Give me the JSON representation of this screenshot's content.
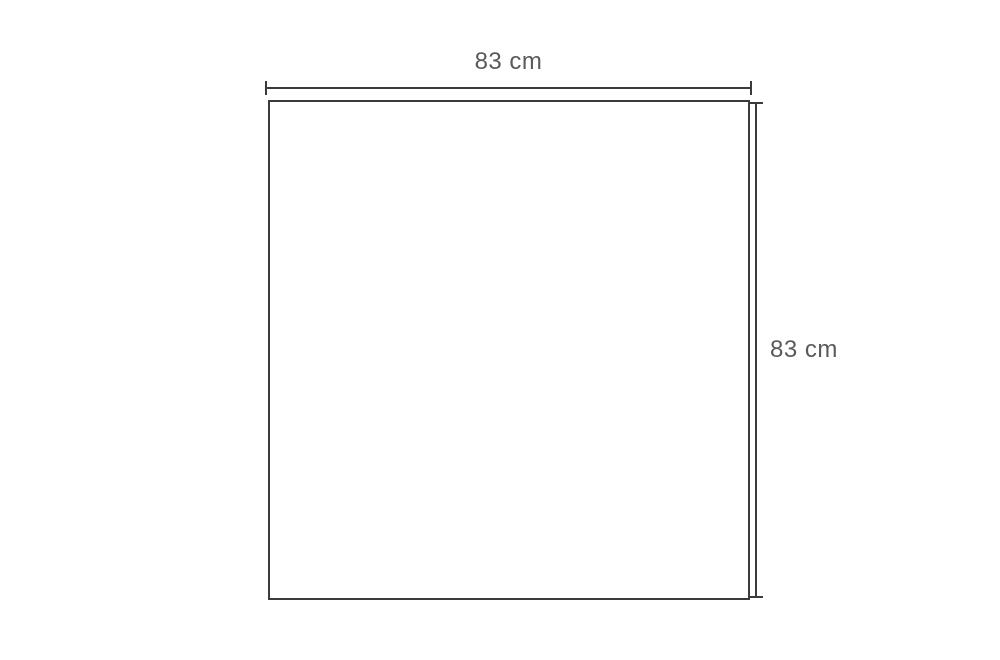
{
  "diagram": {
    "type": "dimension-diagram",
    "shape": "square",
    "width": {
      "label": "83 cm",
      "value": 83,
      "unit": "cm"
    },
    "height": {
      "label": "83 cm",
      "value": 83,
      "unit": "cm"
    },
    "colors": {
      "line": "#3b3b3b",
      "text": "#5a5a5a",
      "background": "#ffffff"
    }
  }
}
